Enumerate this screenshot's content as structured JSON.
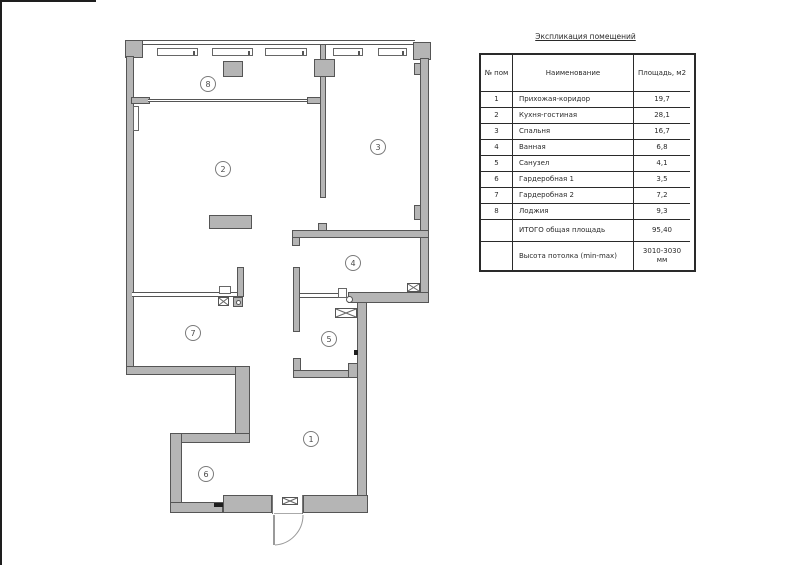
{
  "table": {
    "title": "Экспликация помещений",
    "headers": {
      "num": "№ пом",
      "name": "Наименование",
      "area": "Площадь, м2"
    },
    "rows": [
      {
        "num": "1",
        "name": "Прихожая-коридор",
        "area": "19,7"
      },
      {
        "num": "2",
        "name": "Кухня-гостиная",
        "area": "28,1"
      },
      {
        "num": "3",
        "name": "Спальня",
        "area": "16,7"
      },
      {
        "num": "4",
        "name": "Ванная",
        "area": "6,8"
      },
      {
        "num": "5",
        "name": "Санузел",
        "area": "4,1"
      },
      {
        "num": "6",
        "name": "Гардеробная 1",
        "area": "3,5"
      },
      {
        "num": "7",
        "name": "Гардеробная 2",
        "area": "7,2"
      },
      {
        "num": "8",
        "name": "Лоджия",
        "area": "9,3"
      }
    ],
    "total": {
      "label": "ИТОГО общая площадь",
      "value": "95,40"
    },
    "ceiling": {
      "label": "Высота потолка (min-max)",
      "value": "3010-3030 мм"
    }
  },
  "plan": {
    "rooms": [
      {
        "num": "1"
      },
      {
        "num": "2"
      },
      {
        "num": "3"
      },
      {
        "num": "4"
      },
      {
        "num": "5"
      },
      {
        "num": "6"
      },
      {
        "num": "7"
      },
      {
        "num": "8"
      }
    ],
    "colors": {
      "wall_fill": "#b5b5b5",
      "wall_line": "#555555"
    }
  }
}
